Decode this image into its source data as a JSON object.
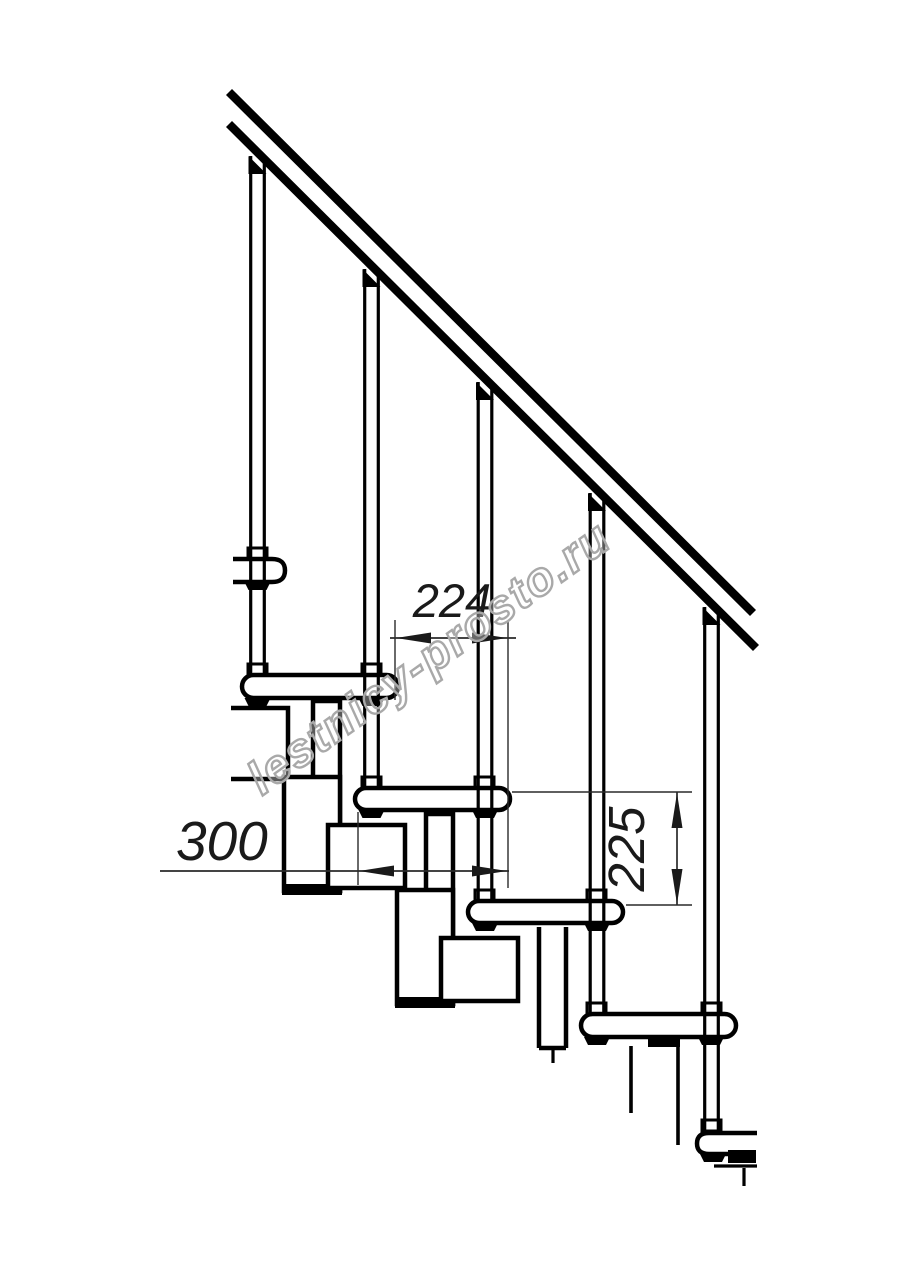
{
  "drawing": {
    "kind": "modular staircase side elevation, section fragment",
    "background_color": "#ffffff",
    "line_color": "#000000",
    "dimension_line_color": "#2a2a2a",
    "balusters_count": 5,
    "treads_visible": 6
  },
  "dimensions": {
    "run": {
      "value": "224",
      "orientation": "horizontal"
    },
    "tread": {
      "value": "300",
      "orientation": "horizontal"
    },
    "rise": {
      "value": "225",
      "orientation": "vertical"
    }
  },
  "watermark": {
    "text": "lestnicy-prosto.ru",
    "color": "#a9a9a9"
  }
}
